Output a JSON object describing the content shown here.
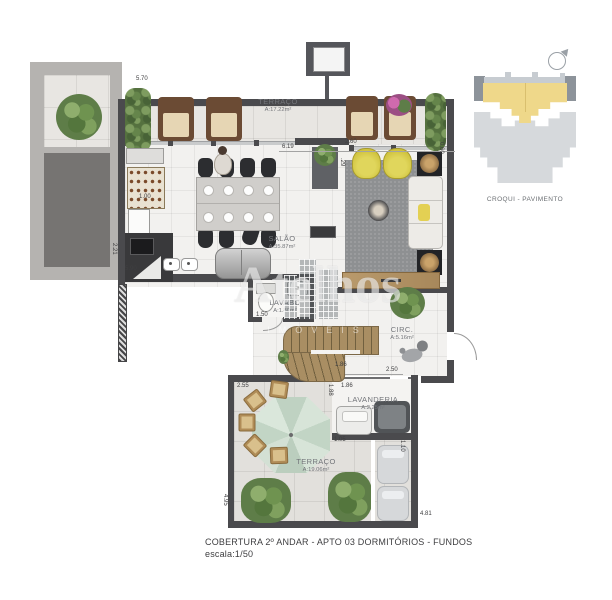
{
  "caption": {
    "line1": "COBERTURA 2º ANDAR - APTO 03 DORMITÓRIOS - FUNDOS",
    "line2": "escala:1/50"
  },
  "croqui": {
    "label": "CROQUI - PAVIMENTO"
  },
  "watermark": {
    "brand": "Atelhos",
    "sub": "IMÓVEIS"
  },
  "rooms": {
    "terraco_top": {
      "name": "TERRAÇO",
      "area": "A:17.22m²"
    },
    "salao": {
      "name": "SALÃO",
      "area": "A:35.87m²"
    },
    "lavabo": {
      "name": "LAVABO",
      "area": "A:1.80m²"
    },
    "circ": {
      "name": "CIRC.",
      "area": "A:5.16m²"
    },
    "lavanderia": {
      "name": "LAVANDERIA",
      "area": "A:2.25m²"
    },
    "terraco_bottom": {
      "name": "TERRAÇO",
      "area": "A:19.06m²"
    }
  },
  "dims": {
    "top_left": "5.70",
    "terrace_opening": "6.19",
    "living_opening": "2.60",
    "step": ".29",
    "kitchen_niche": "1.00",
    "left_wall_v": "2.21",
    "kitchen_run": "5.90",
    "living_right_v": "0.60",
    "lavabo_door": "1.50",
    "circ_width": "2.50",
    "stairs_a": "1.86",
    "stairs_b": "1.86",
    "lavanderia_v": "1.88",
    "lavanderia_door": "1.05",
    "lavanderia_right_v": "1.10",
    "terrace2_top": "2.55",
    "terrace2_left_v": "4.95",
    "terrace2_bottom": "4.81"
  }
}
